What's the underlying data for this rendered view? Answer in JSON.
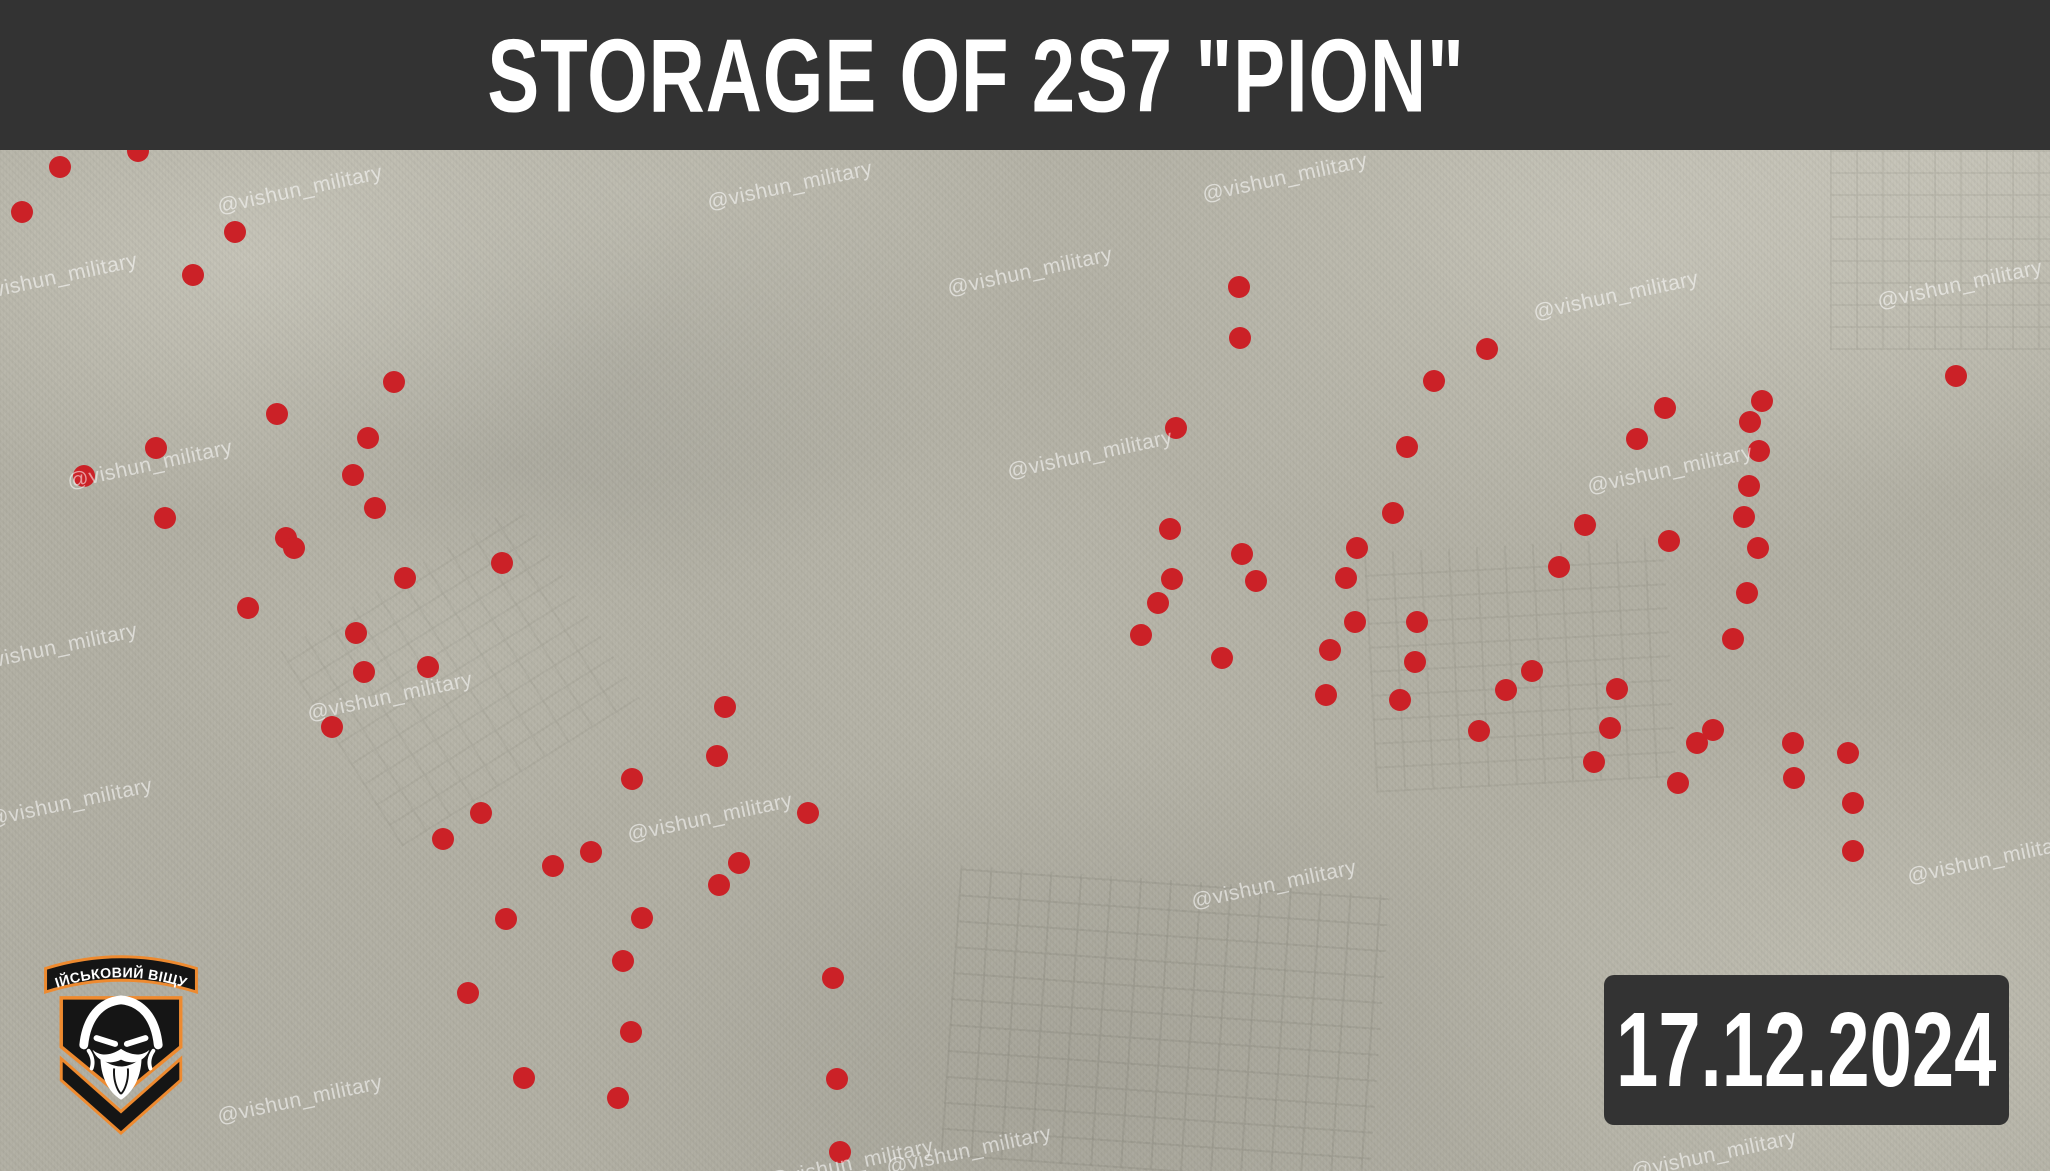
{
  "title_bar": {
    "title": "STORAGE OF 2S7 \"PION\"",
    "bg_color": "#333333",
    "text_color": "#ffffff"
  },
  "date_badge": {
    "text": "17.12.2024",
    "bg_color": "#333333",
    "text_color": "#ffffff"
  },
  "logo": {
    "banner_text": "ВІЙСЬКОВИЙ ВІЩУН",
    "accent_color": "#ee8a2f",
    "shield_color": "#151515",
    "face_color": "#ffffff"
  },
  "watermarks": {
    "text": "@vishun_military",
    "color": "#ffffff",
    "opacity": 0.55,
    "rotation_deg": -12,
    "positions": [
      [
        300,
        190
      ],
      [
        790,
        186
      ],
      [
        1285,
        178
      ],
      [
        1960,
        285
      ],
      [
        55,
        278
      ],
      [
        1030,
        272
      ],
      [
        1616,
        296
      ],
      [
        150,
        465
      ],
      [
        1090,
        455
      ],
      [
        1670,
        470
      ],
      [
        390,
        697
      ],
      [
        55,
        648
      ],
      [
        1274,
        885
      ],
      [
        70,
        803
      ],
      [
        710,
        818
      ],
      [
        1990,
        860
      ],
      [
        969,
        1151
      ],
      [
        851,
        1164
      ],
      [
        1714,
        1155
      ],
      [
        300,
        1100
      ]
    ]
  },
  "markers": {
    "color": "#cb2127",
    "radius_px": 11,
    "points": [
      [
        60,
        167
      ],
      [
        22,
        212
      ],
      [
        138,
        151
      ],
      [
        235,
        232
      ],
      [
        193,
        275
      ],
      [
        394,
        382
      ],
      [
        277,
        414
      ],
      [
        368,
        438
      ],
      [
        156,
        448
      ],
      [
        84,
        476
      ],
      [
        353,
        475
      ],
      [
        375,
        508
      ],
      [
        165,
        518
      ],
      [
        286,
        538
      ],
      [
        294,
        548
      ],
      [
        502,
        563
      ],
      [
        405,
        578
      ],
      [
        248,
        608
      ],
      [
        356,
        633
      ],
      [
        428,
        667
      ],
      [
        364,
        672
      ],
      [
        332,
        727
      ],
      [
        481,
        813
      ],
      [
        443,
        839
      ],
      [
        591,
        852
      ],
      [
        553,
        866
      ],
      [
        506,
        919
      ],
      [
        642,
        918
      ],
      [
        623,
        961
      ],
      [
        468,
        993
      ],
      [
        631,
        1032
      ],
      [
        524,
        1078
      ],
      [
        618,
        1098
      ],
      [
        725,
        707
      ],
      [
        717,
        756
      ],
      [
        632,
        779
      ],
      [
        808,
        813
      ],
      [
        739,
        863
      ],
      [
        719,
        885
      ],
      [
        833,
        978
      ],
      [
        837,
        1079
      ],
      [
        840,
        1152
      ],
      [
        1239,
        287
      ],
      [
        1240,
        338
      ],
      [
        1176,
        428
      ],
      [
        1170,
        529
      ],
      [
        1242,
        554
      ],
      [
        1172,
        579
      ],
      [
        1256,
        581
      ],
      [
        1158,
        603
      ],
      [
        1141,
        635
      ],
      [
        1222,
        658
      ],
      [
        1330,
        650
      ],
      [
        1326,
        695
      ],
      [
        1487,
        349
      ],
      [
        1434,
        381
      ],
      [
        1407,
        447
      ],
      [
        1393,
        513
      ],
      [
        1665,
        408
      ],
      [
        1637,
        439
      ],
      [
        1585,
        525
      ],
      [
        1669,
        541
      ],
      [
        1559,
        567
      ],
      [
        1762,
        401
      ],
      [
        1750,
        422
      ],
      [
        1759,
        451
      ],
      [
        1749,
        486
      ],
      [
        1744,
        517
      ],
      [
        1758,
        548
      ],
      [
        1747,
        593
      ],
      [
        1733,
        639
      ],
      [
        1357,
        548
      ],
      [
        1346,
        578
      ],
      [
        1355,
        622
      ],
      [
        1417,
        622
      ],
      [
        1415,
        662
      ],
      [
        1400,
        700
      ],
      [
        1532,
        671
      ],
      [
        1506,
        690
      ],
      [
        1479,
        731
      ],
      [
        1617,
        689
      ],
      [
        1610,
        728
      ],
      [
        1594,
        762
      ],
      [
        1697,
        743
      ],
      [
        1713,
        730
      ],
      [
        1678,
        783
      ],
      [
        1793,
        743
      ],
      [
        1794,
        778
      ],
      [
        1848,
        753
      ],
      [
        1853,
        803
      ],
      [
        1853,
        851
      ],
      [
        1956,
        376
      ]
    ]
  },
  "map": {
    "base_color": "#b2b0a4"
  }
}
